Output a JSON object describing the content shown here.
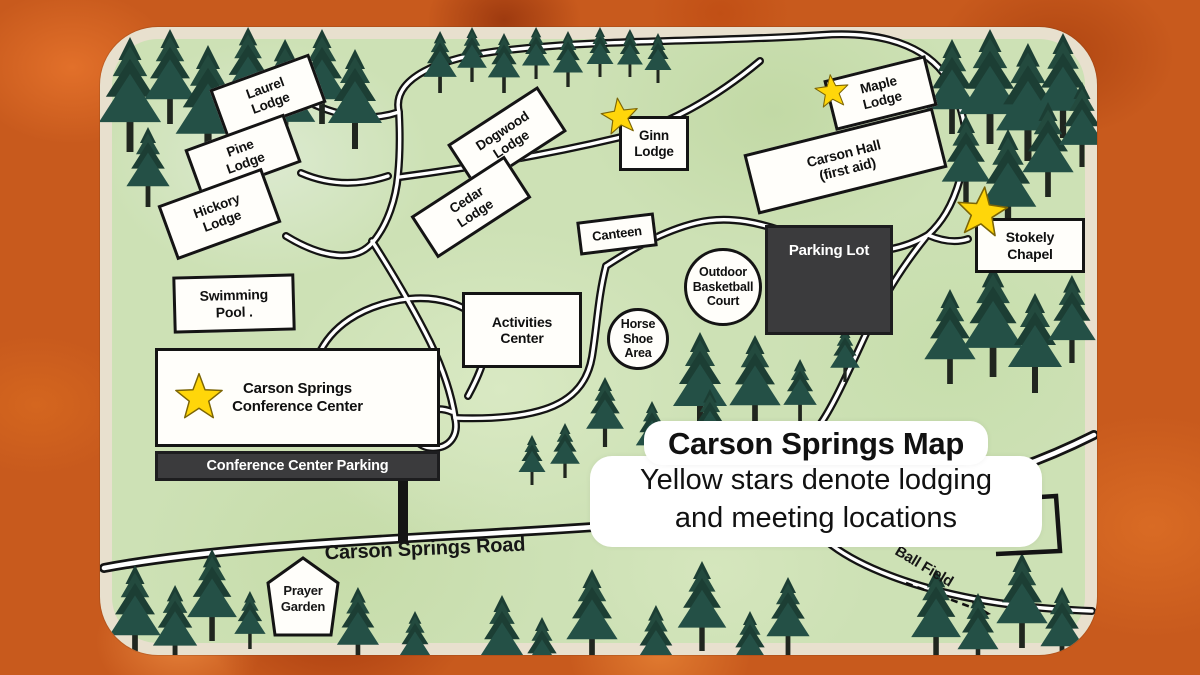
{
  "map": {
    "legend": {
      "title": "Carson Springs Map",
      "line1": "Yellow stars denote lodging",
      "line2": "and meeting locations"
    },
    "road_label": "Carson Springs Road",
    "ball_field_label": "Ball Field",
    "locations": {
      "laurel": "Laurel\nLodge",
      "pine": "Pine\nLodge",
      "hickory": "Hickory\nLodge",
      "dogwood": "Dogwood\nLodge",
      "cedar": "Cedar\nLodge",
      "ginn": "Ginn\nLodge",
      "maple": "Maple\nLodge",
      "carson_hall": "Carson Hall\n(first aid)",
      "stokely": "Stokely\nChapel",
      "canteen": "Canteen",
      "basketball": "Outdoor\nBasketball\nCourt",
      "parking": "Parking Lot",
      "swimming": "Swimming\nPool .",
      "activities": "Activities\nCenter",
      "horseshoe": "Horse\nShoe\nArea",
      "conference": "Carson Springs\nConference Center",
      "conference_parking": "Conference Center Parking",
      "prayer_garden": "Prayer\nGarden"
    },
    "icons": {
      "star": "yellow-star",
      "tree": "evergreen-tree",
      "arrow": "dashed-arrow-to-ball-field"
    },
    "colors": {
      "background_orange": "#c85a1d",
      "map_green": "#cde1b5",
      "map_border_cream": "#e8e0ce",
      "road_black": "#141414",
      "building_white": "#fffefa",
      "parking_dark": "#3b3b3d",
      "star_yellow": "#ffd60a"
    }
  }
}
